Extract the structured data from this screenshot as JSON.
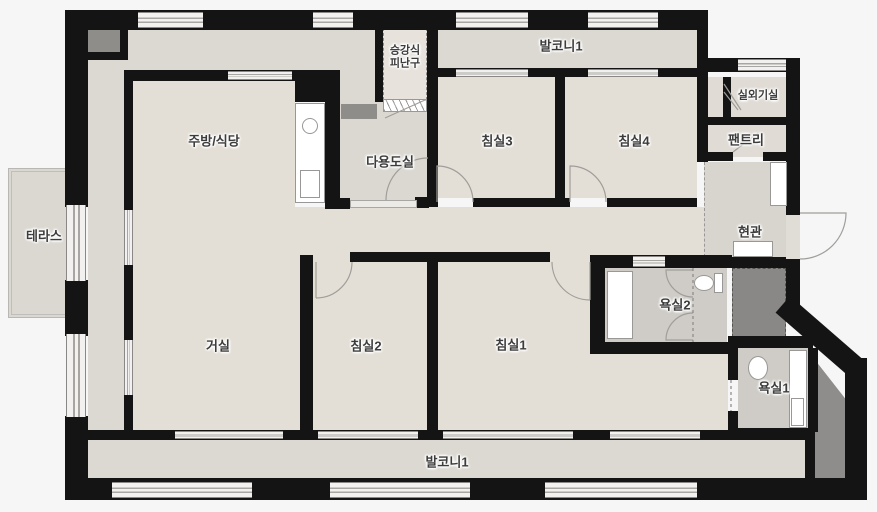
{
  "palette": {
    "wall": "#141414",
    "room_floor": "#e4dfd6",
    "balcony_floor": "#dcd9d2",
    "bathroom_floor": "#cfccc7",
    "entrance_floor": "#d8d5ce",
    "shaft_gray": "#8f8d8a",
    "background": "#f6f6f6",
    "window_glass": "#f2f1ef",
    "label_text": "#3c3c3c"
  },
  "rooms": {
    "terrace": "테라스",
    "kitchen_dining": "주방/식당",
    "evac_hatch_line1": "승강식",
    "evac_hatch_line2": "피난구",
    "balcony_top": "발코니1",
    "bedroom3": "침실3",
    "bedroom4": "침실4",
    "outdoor_unit_room": "실외기실",
    "pantry": "팬트리",
    "utility_room": "다용도실",
    "entrance": "현관",
    "bathroom2": "욕실2",
    "living_room": "거실",
    "bedroom2": "침실2",
    "bedroom1": "침실1",
    "bathroom1": "욕실1",
    "balcony_bottom": "발코니1"
  }
}
